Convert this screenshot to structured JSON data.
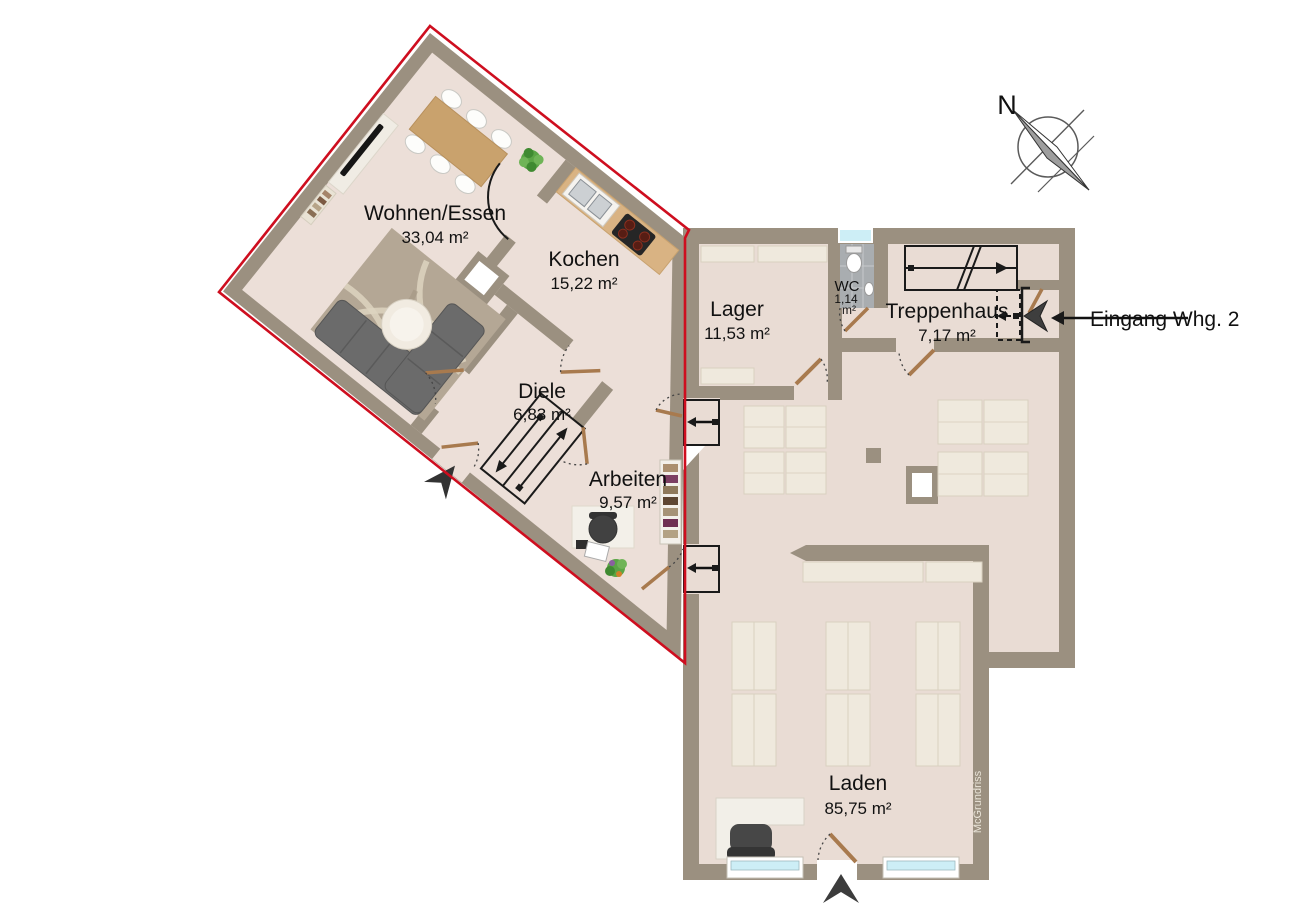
{
  "plan": {
    "type": "floorplan",
    "rooms": [
      {
        "name": "Wohnen/Essen",
        "area": "33,04 m²"
      },
      {
        "name": "Kochen",
        "area": "15,22 m²"
      },
      {
        "name": "Diele",
        "area": "6,83 m²"
      },
      {
        "name": "Arbeiten",
        "area": "9,57 m²"
      },
      {
        "name": "Lager",
        "area": "11,53 m²"
      },
      {
        "name": "WC",
        "area_value": "1,14",
        "area_unit": "m²"
      },
      {
        "name": "Treppenhaus",
        "area": "7,17 m²"
      },
      {
        "name": "Laden",
        "area": "85,75 m²"
      }
    ],
    "annotations": {
      "entrance_label": "Eingang Whg. 2",
      "compass_north": "N",
      "watermark": "McGrundriss"
    },
    "colors": {
      "outline_red": "#ce0e1f",
      "wall": "#9b9080",
      "floor": "#e9dcd4",
      "floor_wing": "#ecdfd8",
      "shelf": "#efe9dd",
      "counter_wood": "#d9b383",
      "table_wood": "#c9a26d",
      "sofa": "#6b6b6b",
      "rug": "#b4a795",
      "glass": "#cdeef6",
      "tile": "#a9adb0",
      "door_wood": "#a87a4e",
      "ink": "#1a1a1a"
    }
  }
}
